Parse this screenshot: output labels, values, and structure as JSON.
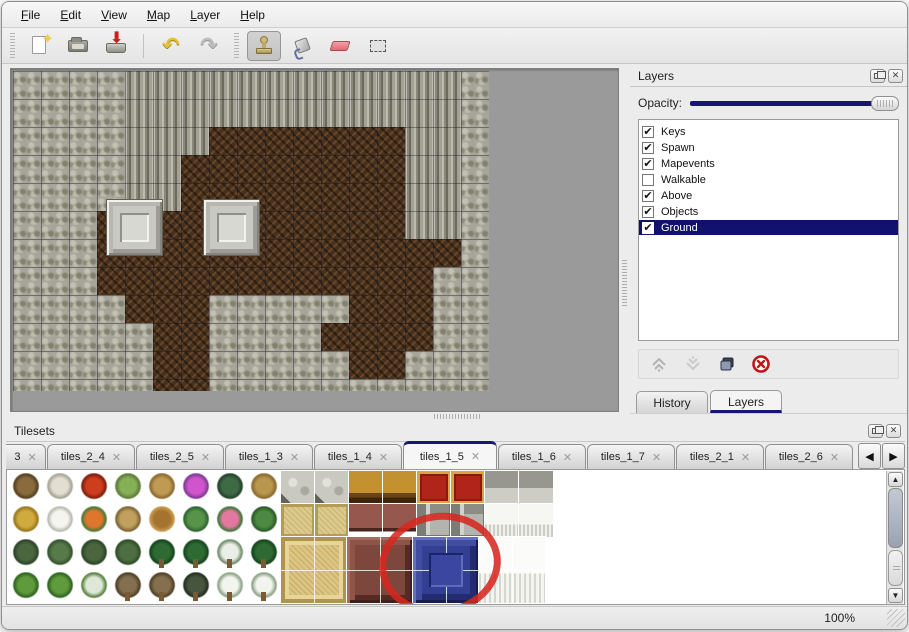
{
  "window": {
    "background": "#ececec",
    "accent_navy": "#15157b"
  },
  "menu": {
    "items": [
      {
        "label": "File"
      },
      {
        "label": "Edit"
      },
      {
        "label": "View"
      },
      {
        "label": "Map"
      },
      {
        "label": "Layer"
      },
      {
        "label": "Help"
      }
    ]
  },
  "toolbar": {
    "buttons": [
      {
        "icon": "new-file",
        "selected": false
      },
      {
        "icon": "open-folder",
        "selected": false
      },
      {
        "icon": "save",
        "selected": false
      },
      {
        "icon": "undo",
        "selected": false
      },
      {
        "icon": "redo",
        "selected": false
      },
      {
        "icon": "stamp-tool",
        "selected": true
      },
      {
        "icon": "fill-tool",
        "selected": false
      },
      {
        "icon": "eraser-tool",
        "selected": false
      },
      {
        "icon": "rect-select-tool",
        "selected": false
      }
    ]
  },
  "map": {
    "tile_legend": {
      "R": "rock-scales",
      "C": "cliff-face",
      "B": "dirt-floor"
    },
    "rows": [
      "RRRRCCCCCCCCCCCCR",
      "RRRRCCCCCCCCCCCCR",
      "RRRRCCCBBBBBBBCCR",
      "RRRRCCBBBBBBBBCCR",
      "RRRRCCBBBBBBBBCCR",
      "RRRBBBBBBBBBBBCCR",
      "RRRBBBBBBBBBBBBBR",
      "RRRBBBBBBBBBBBBRR",
      "RRRRBBBRRRRRBBBRR",
      "RRRRRBBRRRRBBBBRR",
      "RRRRRBBRRRRRBBRRR",
      "RRRRRBBRRRRRRRRRR"
    ],
    "objects": [
      {
        "type": "pedestal",
        "x": 93,
        "y": 128
      },
      {
        "type": "pedestal",
        "x": 190,
        "y": 128
      }
    ]
  },
  "layers_panel": {
    "title": "Layers",
    "opacity_label": "Opacity:",
    "opacity_percent": 100,
    "layers": [
      {
        "name": "Keys",
        "checked": true,
        "selected": false
      },
      {
        "name": "Spawn",
        "checked": true,
        "selected": false
      },
      {
        "name": "Mapevents",
        "checked": true,
        "selected": false
      },
      {
        "name": "Walkable",
        "checked": false,
        "selected": false
      },
      {
        "name": "Above",
        "checked": true,
        "selected": false
      },
      {
        "name": "Objects",
        "checked": true,
        "selected": false
      },
      {
        "name": "Ground",
        "checked": true,
        "selected": true
      }
    ],
    "check_glyph": "✔",
    "action_icons": [
      "raise-layer",
      "lower-layer",
      "duplicate-layer",
      "delete-layer"
    ],
    "tabs": [
      {
        "label": "History",
        "active": false
      },
      {
        "label": "Layers",
        "active": true
      }
    ]
  },
  "tilesets_panel": {
    "title": "Tilesets",
    "close_glyph": "✕",
    "tabs": [
      {
        "label": "3",
        "active": false,
        "truncated": true
      },
      {
        "label": "tiles_2_4",
        "active": false
      },
      {
        "label": "tiles_2_5",
        "active": false
      },
      {
        "label": "tiles_1_3",
        "active": false
      },
      {
        "label": "tiles_1_4",
        "active": false
      },
      {
        "label": "tiles_1_5",
        "active": true
      },
      {
        "label": "tiles_1_6",
        "active": false
      },
      {
        "label": "tiles_1_7",
        "active": false
      },
      {
        "label": "tiles_2_1",
        "active": false
      },
      {
        "label": "tiles_2_6",
        "active": false
      }
    ],
    "scroll_left_glyph": "◀",
    "scroll_right_glyph": "▶",
    "palette": {
      "vegetation_rows": [
        [
          "trunk",
          "dead-tree",
          "red-bloom",
          "stump",
          "palm-trunk",
          "purple-flowers",
          "fern",
          "twigs"
        ],
        [
          "hay-mound",
          "snow-mound",
          "orange-flowers",
          "dry-grass",
          "leaves",
          "lily-pads",
          "roses",
          "lily-pad"
        ],
        [
          "shrubs",
          "shrub-cluster",
          "shrubs",
          "shrub",
          "palm-tree",
          "palm-tree",
          "snow-tree",
          "palm-tree"
        ],
        [
          "bush",
          "bush",
          "bush-snow",
          "dead-tree-tall",
          "dead-tree-tall",
          "dark-tree",
          "snow-pine",
          "snow-pine"
        ]
      ],
      "decor_rows": [
        [
          "stone-floor",
          "stone-floor",
          "wood-table",
          "wood-table",
          "red-carpet",
          "red-carpet",
          "gray-wall",
          "gray-wall"
        ],
        [
          "tan-carpet",
          "tan-carpet",
          "maroon-seat",
          "maroon-seat",
          "metal-blocks",
          "metal-blocks",
          "white-table",
          "white-table"
        ]
      ],
      "large_tiles": [
        "tan-rug",
        "maroon-table",
        "blue-pedestal",
        "white-curtain"
      ],
      "highlighted_tile": "blue-pedestal"
    }
  },
  "annotation": {
    "shape": "red-circle",
    "color": "#d62820",
    "target": "blue-pedestal"
  },
  "status": {
    "zoom_level": "100%"
  }
}
